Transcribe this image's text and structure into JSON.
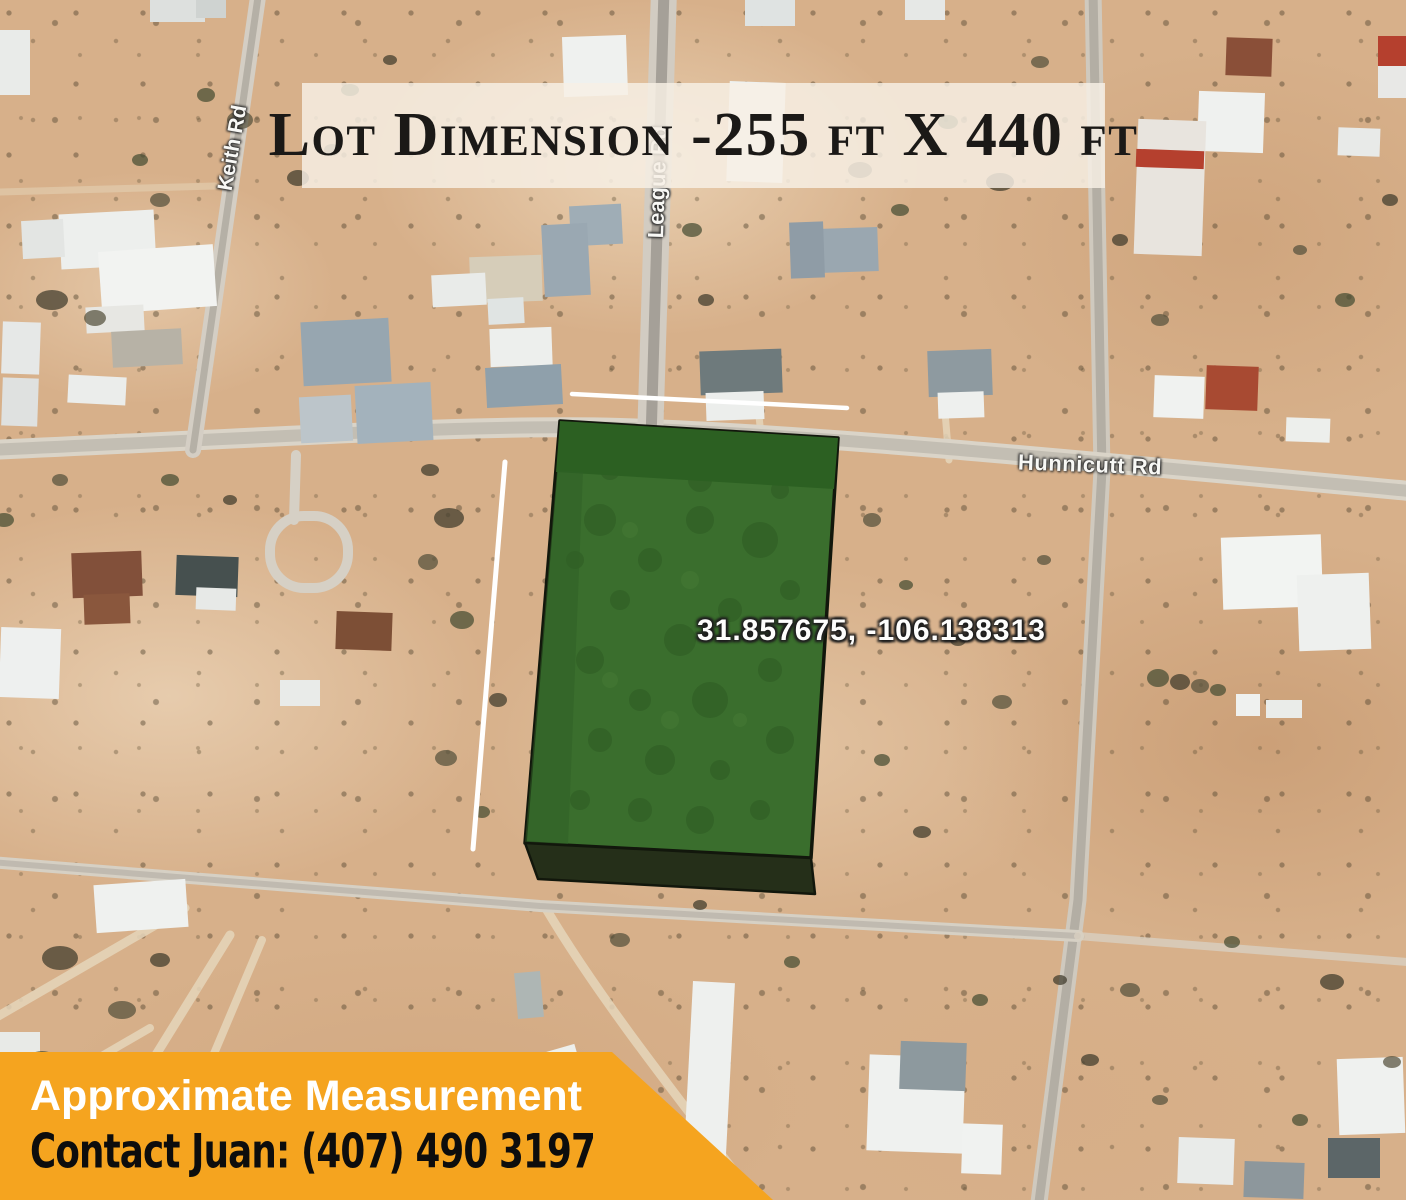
{
  "title_banner": {
    "text": "Lot Dimension -255 ft X 440 ft"
  },
  "map": {
    "road_labels": {
      "keith": "Keith Rd",
      "league": "League Rd",
      "hunnicutt": "Hunnicutt Rd"
    },
    "parcel": {
      "coordinates": "31.857675, -106.138313",
      "fill_color": "#3a6e2d",
      "top_shade_color": "#2c6022",
      "extrusion_color": "#252f19",
      "outline_color": "#12170c"
    },
    "measurement_line_color": "#ffffff"
  },
  "footer_banner": {
    "heading": "Approximate Measurement",
    "contact": "Contact Juan: (407) 490 3197",
    "background_color": "#f5a41f"
  }
}
